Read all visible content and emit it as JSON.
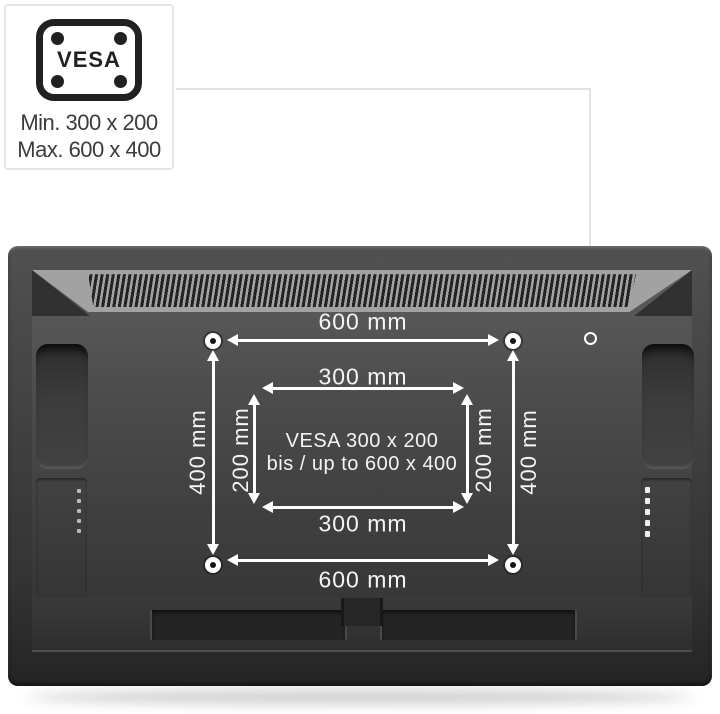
{
  "badge": {
    "vesa_label": "VESA",
    "min_size": "Min. 300 x 200",
    "max_size": "Max. 600 x 400"
  },
  "diagram": {
    "top_width": "600 mm",
    "inner_top_width": "300 mm",
    "left_height": "400 mm",
    "left_inner_height": "200 mm",
    "right_inner_height": "200 mm",
    "right_height": "400 mm",
    "inner_bottom_width": "300 mm",
    "bottom_width": "600 mm",
    "center_line1": "VESA 300 x 200",
    "center_line2": "bis / up to 600 x 400"
  },
  "colors": {
    "background": "#ffffff",
    "annotation": "#ffffff",
    "tv_panel_gray": "#4a4a4a",
    "vent_band_gray": "#a2a2a2",
    "badge_border": "#e5e5e5",
    "badge_text": "#3c3c3c"
  }
}
